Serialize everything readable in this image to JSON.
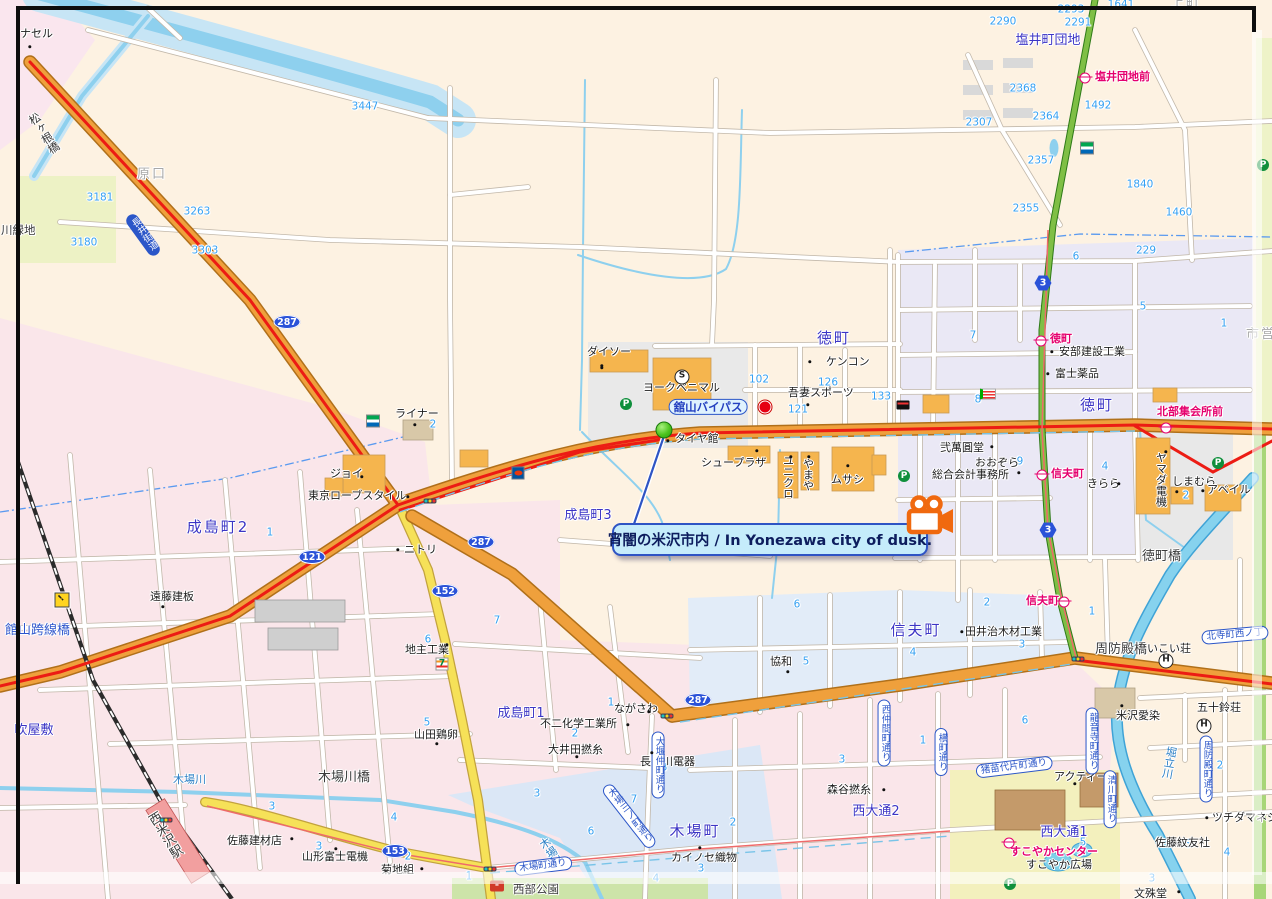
{
  "callout": {
    "text": "宵闇の米沢市内 / In Yonezawa city of dusk."
  },
  "colors": {
    "road_orange": "#efa03c",
    "road_yellow": "#f6e158",
    "route_red": "#ec1c14",
    "water": "#8ed0ee",
    "callout_bg": "#c5ecfb",
    "callout_border": "#2e54c4",
    "camera_orange": "#f0690f",
    "bus_pink": "#e5006e",
    "district_text": "#3c35c5",
    "number_blue": "#35a0f2"
  },
  "labels": [
    {
      "t": "塩井町団地",
      "x": 1048,
      "y": 41,
      "cls": "d big",
      "a": "c"
    },
    {
      "t": "徳町",
      "x": 834,
      "y": 339,
      "cls": "d dlg",
      "a": "c"
    },
    {
      "t": "徳町",
      "x": 1097,
      "y": 406,
      "cls": "d dlg",
      "a": "c"
    },
    {
      "t": "成島町2",
      "x": 218,
      "y": 528,
      "cls": "d dlg",
      "a": "c"
    },
    {
      "t": "成島町3",
      "x": 588,
      "y": 516,
      "cls": "d",
      "a": "c"
    },
    {
      "t": "成島町1",
      "x": 521,
      "y": 714,
      "cls": "d",
      "a": "c"
    },
    {
      "t": "信夫町",
      "x": 916,
      "y": 631,
      "cls": "d dlg",
      "a": "c"
    },
    {
      "t": "木場町",
      "x": 695,
      "y": 832,
      "cls": "d dlg",
      "a": "c"
    },
    {
      "t": "西大通2",
      "x": 876,
      "y": 812,
      "cls": "d big",
      "a": "c"
    },
    {
      "t": "西大通1",
      "x": 1064,
      "y": 833,
      "cls": "d big",
      "a": "c"
    },
    {
      "t": "吹屋敷",
      "x": 34,
      "y": 731,
      "cls": "d",
      "a": "c"
    },
    {
      "t": "原口",
      "x": 152,
      "y": 175,
      "cls": "dgray",
      "a": "c"
    },
    {
      "t": "上町",
      "x": 1186,
      "y": 4,
      "cls": "dgray",
      "a": "c"
    },
    {
      "t": "市営",
      "x": 1261,
      "y": 335,
      "cls": "dgray",
      "a": "c"
    },
    {
      "t": "川緑地",
      "x": 1,
      "y": 224,
      "cls": "g"
    },
    {
      "t": "3447",
      "x": 365,
      "y": 107,
      "cls": "n",
      "a": "c"
    },
    {
      "t": "3181",
      "x": 100,
      "y": 198,
      "cls": "n",
      "a": "c"
    },
    {
      "t": "3180",
      "x": 84,
      "y": 243,
      "cls": "n",
      "a": "c"
    },
    {
      "t": "3263",
      "x": 197,
      "y": 212,
      "cls": "n",
      "a": "c"
    },
    {
      "t": "3303",
      "x": 205,
      "y": 251,
      "cls": "n",
      "a": "c"
    },
    {
      "t": "2293",
      "x": 1071,
      "y": 10,
      "cls": "n",
      "a": "c"
    },
    {
      "t": "2290",
      "x": 1003,
      "y": 22,
      "cls": "n",
      "a": "c"
    },
    {
      "t": "2291",
      "x": 1078,
      "y": 23,
      "cls": "n",
      "a": "c"
    },
    {
      "t": "1641",
      "x": 1121,
      "y": 5,
      "cls": "n",
      "a": "c"
    },
    {
      "t": "2368",
      "x": 1023,
      "y": 89,
      "cls": "n",
      "a": "c"
    },
    {
      "t": "2364",
      "x": 1046,
      "y": 117,
      "cls": "n",
      "a": "c"
    },
    {
      "t": "2307",
      "x": 979,
      "y": 123,
      "cls": "n",
      "a": "c"
    },
    {
      "t": "1492",
      "x": 1098,
      "y": 106,
      "cls": "n",
      "a": "c"
    },
    {
      "t": "2357",
      "x": 1041,
      "y": 161,
      "cls": "n",
      "a": "c"
    },
    {
      "t": "1840",
      "x": 1140,
      "y": 185,
      "cls": "n",
      "a": "c"
    },
    {
      "t": "2355",
      "x": 1026,
      "y": 209,
      "cls": "n",
      "a": "c"
    },
    {
      "t": "1460",
      "x": 1179,
      "y": 213,
      "cls": "n",
      "a": "c"
    },
    {
      "t": "229",
      "x": 1146,
      "y": 251,
      "cls": "n",
      "a": "c"
    },
    {
      "t": "6",
      "x": 1076,
      "y": 257,
      "cls": "n",
      "a": "c"
    },
    {
      "t": "5",
      "x": 1143,
      "y": 307,
      "cls": "n",
      "a": "c"
    },
    {
      "t": "1",
      "x": 1224,
      "y": 324,
      "cls": "n",
      "a": "c"
    },
    {
      "t": "7",
      "x": 973,
      "y": 336,
      "cls": "n",
      "a": "c"
    },
    {
      "t": "102",
      "x": 759,
      "y": 380,
      "cls": "n",
      "a": "c"
    },
    {
      "t": "126",
      "x": 828,
      "y": 383,
      "cls": "n",
      "a": "c"
    },
    {
      "t": "121",
      "x": 798,
      "y": 410,
      "cls": "n",
      "a": "c"
    },
    {
      "t": "133",
      "x": 881,
      "y": 397,
      "cls": "n",
      "a": "c"
    },
    {
      "t": "8",
      "x": 978,
      "y": 400,
      "cls": "n",
      "a": "c"
    },
    {
      "t": "9",
      "x": 1020,
      "y": 462,
      "cls": "n",
      "a": "c"
    },
    {
      "t": "4",
      "x": 1105,
      "y": 467,
      "cls": "n",
      "a": "c"
    },
    {
      "t": "2",
      "x": 1186,
      "y": 496,
      "cls": "n",
      "a": "c"
    },
    {
      "t": "1",
      "x": 270,
      "y": 533,
      "cls": "n",
      "a": "c"
    },
    {
      "t": "2",
      "x": 433,
      "y": 425,
      "cls": "n",
      "a": "c"
    },
    {
      "t": "6",
      "x": 428,
      "y": 640,
      "cls": "n",
      "a": "c"
    },
    {
      "t": "7",
      "x": 497,
      "y": 621,
      "cls": "n",
      "a": "c"
    },
    {
      "t": "1",
      "x": 611,
      "y": 703,
      "cls": "n",
      "a": "c"
    },
    {
      "t": "2",
      "x": 575,
      "y": 734,
      "cls": "n",
      "a": "c"
    },
    {
      "t": "5",
      "x": 427,
      "y": 723,
      "cls": "n",
      "a": "c"
    },
    {
      "t": "8",
      "x": 664,
      "y": 768,
      "cls": "n",
      "a": "c"
    },
    {
      "t": "3",
      "x": 272,
      "y": 807,
      "cls": "n",
      "a": "c"
    },
    {
      "t": "4",
      "x": 394,
      "y": 818,
      "cls": "n",
      "a": "c"
    },
    {
      "t": "3",
      "x": 319,
      "y": 847,
      "cls": "n",
      "a": "c"
    },
    {
      "t": "2",
      "x": 408,
      "y": 857,
      "cls": "n",
      "a": "c"
    },
    {
      "t": "3",
      "x": 537,
      "y": 794,
      "cls": "n",
      "a": "c"
    },
    {
      "t": "7",
      "x": 634,
      "y": 800,
      "cls": "n",
      "a": "c"
    },
    {
      "t": "6",
      "x": 591,
      "y": 832,
      "cls": "n",
      "a": "c"
    },
    {
      "t": "5",
      "x": 550,
      "y": 859,
      "cls": "n",
      "a": "c"
    },
    {
      "t": "2",
      "x": 733,
      "y": 823,
      "cls": "n",
      "a": "c"
    },
    {
      "t": "3",
      "x": 701,
      "y": 869,
      "cls": "n",
      "a": "c"
    },
    {
      "t": "4",
      "x": 656,
      "y": 879,
      "cls": "n",
      "a": "c"
    },
    {
      "t": "1",
      "x": 469,
      "y": 877,
      "cls": "n",
      "a": "c"
    },
    {
      "t": "6",
      "x": 797,
      "y": 605,
      "cls": "n",
      "a": "c"
    },
    {
      "t": "2",
      "x": 987,
      "y": 603,
      "cls": "n",
      "a": "c"
    },
    {
      "t": "5",
      "x": 806,
      "y": 662,
      "cls": "n",
      "a": "c"
    },
    {
      "t": "4",
      "x": 913,
      "y": 653,
      "cls": "n",
      "a": "c"
    },
    {
      "t": "3",
      "x": 1022,
      "y": 645,
      "cls": "n",
      "a": "c"
    },
    {
      "t": "1",
      "x": 1092,
      "y": 612,
      "cls": "n",
      "a": "c"
    },
    {
      "t": "1",
      "x": 923,
      "y": 741,
      "cls": "n",
      "a": "c"
    },
    {
      "t": "6",
      "x": 1025,
      "y": 721,
      "cls": "n",
      "a": "c"
    },
    {
      "t": "3",
      "x": 842,
      "y": 760,
      "cls": "n",
      "a": "c"
    },
    {
      "t": "2",
      "x": 1220,
      "y": 766,
      "cls": "n",
      "a": "c"
    },
    {
      "t": "5",
      "x": 1083,
      "y": 843,
      "cls": "n",
      "a": "c"
    },
    {
      "t": "5",
      "x": 1188,
      "y": 845,
      "cls": "n",
      "a": "c"
    },
    {
      "t": "4",
      "x": 1227,
      "y": 853,
      "cls": "n",
      "a": "c"
    },
    {
      "t": "3",
      "x": 1152,
      "y": 879,
      "cls": "n",
      "a": "c"
    },
    {
      "t": "ナセル",
      "x": 20,
      "y": 28,
      "cls": "b"
    },
    {
      "t": "ライナー",
      "x": 395,
      "y": 408,
      "cls": "b"
    },
    {
      "t": "ジョイ",
      "x": 330,
      "y": 468,
      "cls": "b"
    },
    {
      "t": "東京ローブスタイル",
      "x": 308,
      "y": 490,
      "cls": "b"
    },
    {
      "t": "ニトリ",
      "x": 404,
      "y": 544,
      "cls": "b"
    },
    {
      "t": "遠藤建板",
      "x": 150,
      "y": 591,
      "cls": "b"
    },
    {
      "t": "地主工業",
      "x": 405,
      "y": 644,
      "cls": "b"
    },
    {
      "t": "山田鶏卵",
      "x": 414,
      "y": 729,
      "cls": "b"
    },
    {
      "t": "不二化学工業所",
      "x": 540,
      "y": 718,
      "cls": "b"
    },
    {
      "t": "大井田撚糸",
      "x": 548,
      "y": 744,
      "cls": "b"
    },
    {
      "t": "ながさわ",
      "x": 614,
      "y": 703,
      "cls": "b"
    },
    {
      "t": "長谷川電器",
      "x": 640,
      "y": 756,
      "cls": "b"
    },
    {
      "t": "菊地組",
      "x": 381,
      "y": 864,
      "cls": "b"
    },
    {
      "t": "佐藤建材店",
      "x": 227,
      "y": 835,
      "cls": "b"
    },
    {
      "t": "山形富士電機",
      "x": 302,
      "y": 851,
      "cls": "b"
    },
    {
      "t": "カイノセ織物",
      "x": 671,
      "y": 852,
      "cls": "b"
    },
    {
      "t": "森谷撚糸",
      "x": 827,
      "y": 784,
      "cls": "b"
    },
    {
      "t": "協和",
      "x": 770,
      "y": 656,
      "cls": "b"
    },
    {
      "t": "田井治木材工業",
      "x": 965,
      "y": 626,
      "cls": "b"
    },
    {
      "t": "アクティー",
      "x": 1054,
      "y": 771,
      "cls": "b"
    },
    {
      "t": "米沢愛染",
      "x": 1116,
      "y": 710,
      "cls": "b"
    },
    {
      "t": "ツチダマネジ",
      "x": 1212,
      "y": 812,
      "cls": "b"
    },
    {
      "t": "文殊堂",
      "x": 1134,
      "y": 888,
      "cls": "b"
    },
    {
      "t": "佐藤紋友社",
      "x": 1155,
      "y": 837,
      "cls": "b"
    },
    {
      "t": "安部建設工業",
      "x": 1059,
      "y": 346,
      "cls": "b"
    },
    {
      "t": "富士薬品",
      "x": 1055,
      "y": 368,
      "cls": "b"
    },
    {
      "t": "弐萬圓堂",
      "x": 940,
      "y": 442,
      "cls": "b"
    },
    {
      "t": "おおぞら",
      "x": 975,
      "y": 457,
      "cls": "b"
    },
    {
      "t": "総合会計事務所",
      "x": 932,
      "y": 469,
      "cls": "b"
    },
    {
      "t": "きらら",
      "x": 1087,
      "y": 478,
      "cls": "b"
    },
    {
      "t": "しまむら",
      "x": 1172,
      "y": 476,
      "cls": "b"
    },
    {
      "t": "アベイル",
      "x": 1207,
      "y": 484,
      "cls": "b"
    },
    {
      "t": "ムサシ",
      "x": 831,
      "y": 474,
      "cls": "b"
    },
    {
      "t": "ケンコン",
      "x": 826,
      "y": 356,
      "cls": "b"
    },
    {
      "t": "吾妻スポーツ",
      "x": 788,
      "y": 387,
      "cls": "b"
    },
    {
      "t": "ダイソー",
      "x": 587,
      "y": 346,
      "cls": "b"
    },
    {
      "t": "ヨークベニマル",
      "x": 643,
      "y": 382,
      "cls": "b"
    },
    {
      "t": "シュープラザ",
      "x": 701,
      "y": 457,
      "cls": "b"
    },
    {
      "t": "タイヤ館",
      "x": 675,
      "y": 433,
      "cls": "b"
    },
    {
      "t": "いこい荘",
      "x": 1147,
      "y": 643,
      "cls": "b"
    },
    {
      "t": "五十鈴荘",
      "x": 1197,
      "y": 702,
      "cls": "b"
    },
    {
      "t": "すこやか広場",
      "x": 1026,
      "y": 859,
      "cls": "b"
    },
    {
      "t": "西部公園",
      "x": 513,
      "y": 883,
      "cls": "g"
    },
    {
      "t": "やまや",
      "x": 802,
      "y": 458,
      "cls": "b v"
    },
    {
      "t": "ユニクロ",
      "x": 782,
      "y": 455,
      "cls": "b v"
    },
    {
      "t": "ヤマダ電機",
      "x": 1155,
      "y": 452,
      "cls": "b v"
    },
    {
      "t": "塩井団地前",
      "x": 1095,
      "y": 71,
      "cls": "p"
    },
    {
      "t": "徳町",
      "x": 1050,
      "y": 333,
      "cls": "p"
    },
    {
      "t": "北部集会所前",
      "x": 1157,
      "y": 406,
      "cls": "p"
    },
    {
      "t": "信夫町",
      "x": 1051,
      "y": 468,
      "cls": "p"
    },
    {
      "t": "信夫町",
      "x": 1026,
      "y": 595,
      "cls": "p"
    },
    {
      "t": "すこやかセンター",
      "x": 1010,
      "y": 846,
      "cls": "p"
    },
    {
      "t": "松ヶ根橋",
      "x": 38,
      "y": 110,
      "cls": "g v",
      "rot": -33
    },
    {
      "t": "館山跨線橋",
      "x": 5,
      "y": 624,
      "cls": "gb big"
    },
    {
      "t": "木場川橋",
      "x": 318,
      "y": 771,
      "cls": "g big"
    },
    {
      "t": "周防殿橋",
      "x": 1095,
      "y": 643,
      "cls": "g big"
    },
    {
      "t": "徳町橋",
      "x": 1142,
      "y": 550,
      "cls": "g big"
    },
    {
      "t": "木場川",
      "x": 173,
      "y": 774,
      "cls": "r"
    },
    {
      "t": "木場川",
      "x": 545,
      "y": 836,
      "cls": "r v",
      "rot": -34
    },
    {
      "t": "堀立川",
      "x": 1163,
      "y": 746,
      "cls": "r v",
      "rot": 10
    },
    {
      "t": "西米沢駅",
      "x": 157,
      "y": 810,
      "cls": "g v big",
      "rot": -32
    }
  ],
  "banners": [
    {
      "t": "舘山バイパス",
      "x": 708,
      "y": 407,
      "st": "light"
    },
    {
      "t": "長井街道",
      "x": 143,
      "y": 235,
      "st": "solid",
      "v": 1,
      "rot": -36
    },
    {
      "t": "木場町通り",
      "x": 543,
      "y": 866,
      "rot": -7
    },
    {
      "t": "木場三ノ町通り",
      "x": 629,
      "y": 816,
      "v": 1,
      "rot": -38
    },
    {
      "t": "大堰仲町通り",
      "x": 658,
      "y": 765,
      "v": 1
    },
    {
      "t": "西仲間町通り",
      "x": 884,
      "y": 733,
      "v": 1
    },
    {
      "t": "横町通り",
      "x": 941,
      "y": 752,
      "v": 1
    },
    {
      "t": "猪苗代片町通り",
      "x": 1014,
      "y": 767,
      "rot": -7
    },
    {
      "t": "龍音寺町通り",
      "x": 1092,
      "y": 741,
      "v": 1
    },
    {
      "t": "清川町通り",
      "x": 1110,
      "y": 799,
      "v": 1
    },
    {
      "t": "周防殿町通り",
      "x": 1206,
      "y": 769,
      "v": 1
    },
    {
      "t": "北寺町西ノ丁",
      "x": 1235,
      "y": 635,
      "rot": -5
    }
  ],
  "shields": [
    {
      "s": "oval",
      "t": "287",
      "x": 287,
      "y": 322
    },
    {
      "s": "oval",
      "t": "287",
      "x": 481,
      "y": 542
    },
    {
      "s": "oval",
      "t": "287",
      "x": 698,
      "y": 700
    },
    {
      "s": "oval",
      "t": "121",
      "x": 312,
      "y": 557
    },
    {
      "s": "oval",
      "t": "152",
      "x": 445,
      "y": 591
    },
    {
      "s": "oval",
      "t": "153",
      "x": 395,
      "y": 851
    },
    {
      "s": "hex",
      "t": "3",
      "x": 1043,
      "y": 283
    },
    {
      "s": "hex",
      "t": "3",
      "x": 1048,
      "y": 530
    }
  ],
  "icons": [
    {
      "k": "parking",
      "x": 626,
      "y": 404
    },
    {
      "k": "parking",
      "x": 904,
      "y": 476
    },
    {
      "k": "parking",
      "x": 1218,
      "y": 463
    },
    {
      "k": "parking",
      "x": 1263,
      "y": 165
    },
    {
      "k": "parking",
      "x": 1010,
      "y": 884
    },
    {
      "k": "seven",
      "x": 442,
      "y": 664
    },
    {
      "k": "family",
      "x": 373,
      "y": 421
    },
    {
      "k": "family",
      "x": 1087,
      "y": 148
    },
    {
      "k": "eneos",
      "x": 518,
      "y": 473
    },
    {
      "k": "redstore",
      "x": 765,
      "y": 407
    },
    {
      "k": "blackstore",
      "x": 903,
      "y": 405
    },
    {
      "k": "flag",
      "x": 988,
      "y": 394
    },
    {
      "k": "cheri",
      "x": 497,
      "y": 886
    },
    {
      "k": "scircle",
      "x": 682,
      "y": 377
    },
    {
      "k": "hcircle",
      "x": 1166,
      "y": 661
    },
    {
      "k": "hcircle",
      "x": 1204,
      "y": 726
    },
    {
      "k": "light",
      "x": 430,
      "y": 501
    },
    {
      "k": "light",
      "x": 490,
      "y": 869
    },
    {
      "k": "light",
      "x": 667,
      "y": 716
    },
    {
      "k": "light",
      "x": 1078,
      "y": 659
    },
    {
      "k": "light",
      "x": 166,
      "y": 820
    },
    {
      "k": "bus",
      "x": 1085,
      "y": 78
    },
    {
      "k": "bus",
      "x": 1041,
      "y": 341
    },
    {
      "k": "bus",
      "x": 1166,
      "y": 428
    },
    {
      "k": "bus",
      "x": 1042,
      "y": 475
    },
    {
      "k": "bus",
      "x": 1064,
      "y": 602
    },
    {
      "k": "bus",
      "x": 1009,
      "y": 843
    },
    {
      "k": "crossing",
      "x": 62,
      "y": 600
    },
    {
      "k": "marker",
      "x": 664,
      "y": 430
    }
  ],
  "dots": [
    [
      30,
      47
    ],
    [
      415,
      425
    ],
    [
      362,
      477
    ],
    [
      408,
      497
    ],
    [
      398,
      550
    ],
    [
      163,
      607
    ],
    [
      447,
      645
    ],
    [
      437,
      744
    ],
    [
      628,
      725
    ],
    [
      577,
      757
    ],
    [
      649,
      712
    ],
    [
      652,
      753
    ],
    [
      422,
      869
    ],
    [
      292,
      839
    ],
    [
      336,
      849
    ],
    [
      700,
      848
    ],
    [
      884,
      790
    ],
    [
      788,
      672
    ],
    [
      962,
      632
    ],
    [
      1075,
      784
    ],
    [
      1122,
      706
    ],
    [
      1207,
      818
    ],
    [
      1179,
      892
    ],
    [
      1052,
      352
    ],
    [
      1048,
      374
    ],
    [
      992,
      447
    ],
    [
      1019,
      473
    ],
    [
      1119,
      484
    ],
    [
      1177,
      492
    ],
    [
      1203,
      491
    ],
    [
      848,
      466
    ],
    [
      810,
      362
    ],
    [
      808,
      405
    ],
    [
      602,
      366
    ],
    [
      757,
      451
    ],
    [
      668,
      441
    ],
    [
      791,
      457
    ],
    [
      809,
      457
    ],
    [
      1166,
      452
    ],
    [
      602,
      368
    ]
  ]
}
